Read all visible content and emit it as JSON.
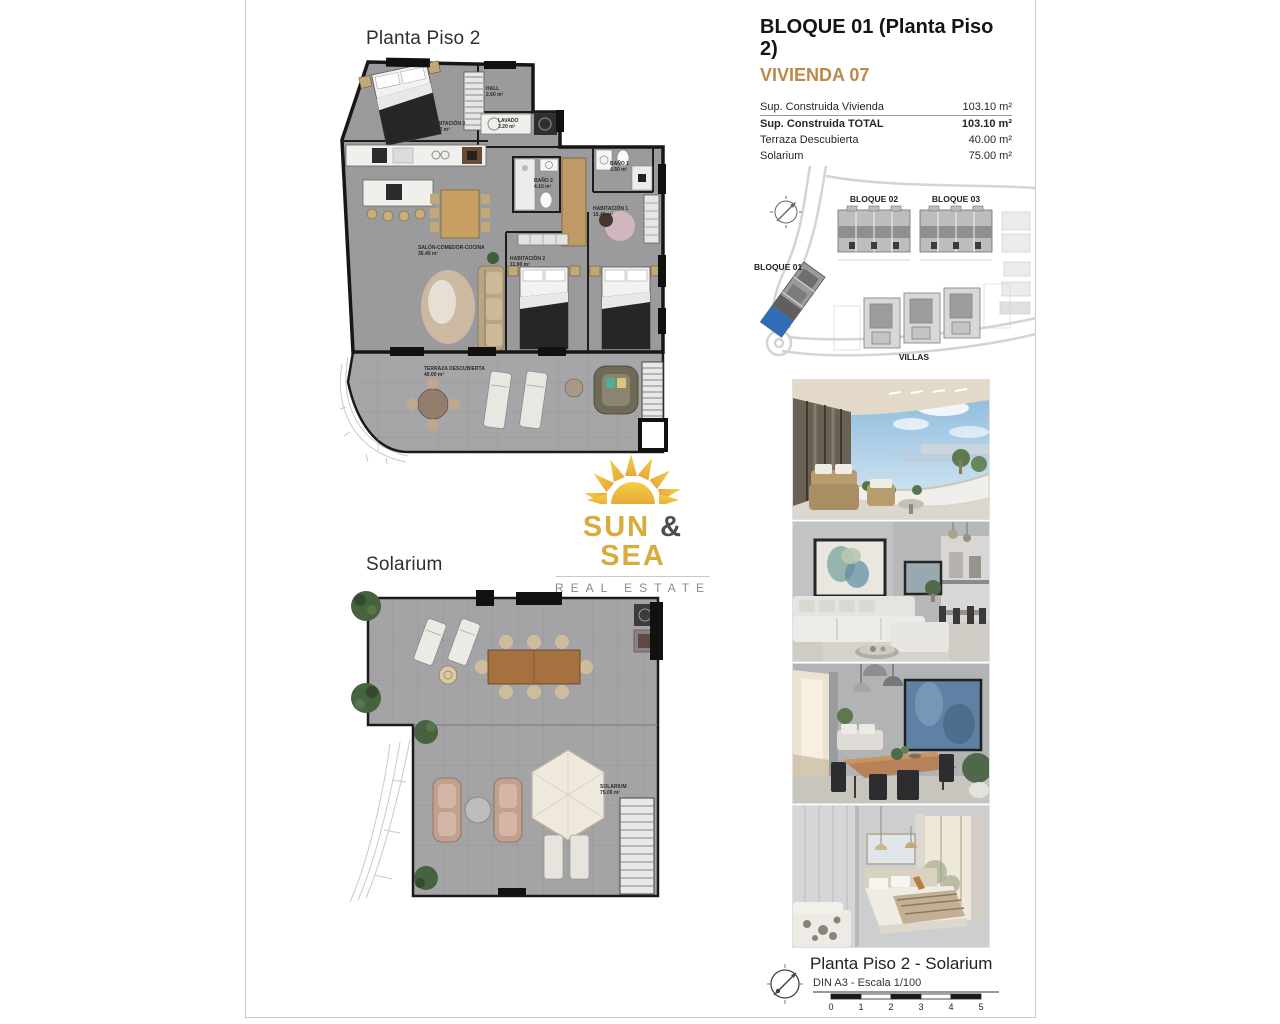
{
  "header": {
    "title": "BLOQUE 01  (Planta Piso 2)",
    "vivienda": "VIVIENDA 07",
    "vivienda_color": "#bf874a",
    "areas": [
      {
        "label": "Sup. Construida Vivienda",
        "value": "103.10 m²"
      },
      {
        "label": "Sup. Construida TOTAL",
        "value": "103.10 m²"
      },
      {
        "label": "Terraza Descubierta",
        "value": "40.00 m²"
      },
      {
        "label": "Solarium",
        "value": "75.00 m²"
      }
    ]
  },
  "site_plan": {
    "bloque01": "BLOQUE 01",
    "bloque02": "BLOQUE 02",
    "bloque03": "BLOQUE 03",
    "villas": "VILLAS",
    "highlight_color": "#2f6db8"
  },
  "plan_piso2": {
    "title": "Planta Piso 2",
    "rooms": [
      {
        "name": "HALL",
        "area": "2.60 m²"
      },
      {
        "name": "HABITACIÓN 3",
        "area": "11.10 m²"
      },
      {
        "name": "LAVADO",
        "area": "3.20 m²"
      },
      {
        "name": "BAÑO 2",
        "area": "4.10 m²"
      },
      {
        "name": "BAÑO 1",
        "area": "4.50 m²"
      },
      {
        "name": "HABITACIÓN 1",
        "area": "15.40 m²"
      },
      {
        "name": "HABITACIÓN 2",
        "area": "11.90 m²"
      },
      {
        "name": "SALÓN-COMEDOR-COCINA",
        "area": "36.40 m²"
      },
      {
        "name": "TERRAZA DESCUBIERTA",
        "area": "40.00 m²"
      }
    ]
  },
  "plan_solarium": {
    "title": "Solarium",
    "room": {
      "name": "SOLARIUM",
      "area": "75.00 m²"
    }
  },
  "logo": {
    "word1": "SUN",
    "amp": "&",
    "word2": "SEA",
    "tagline": "REAL ESTATE",
    "gold": "#d8ab3c"
  },
  "footer": {
    "title": "Planta Piso 2 - Solarium",
    "scale_text": "DIN A3 - Escala 1/100",
    "ticks": [
      "0",
      "1",
      "2",
      "3",
      "4",
      "5"
    ]
  }
}
